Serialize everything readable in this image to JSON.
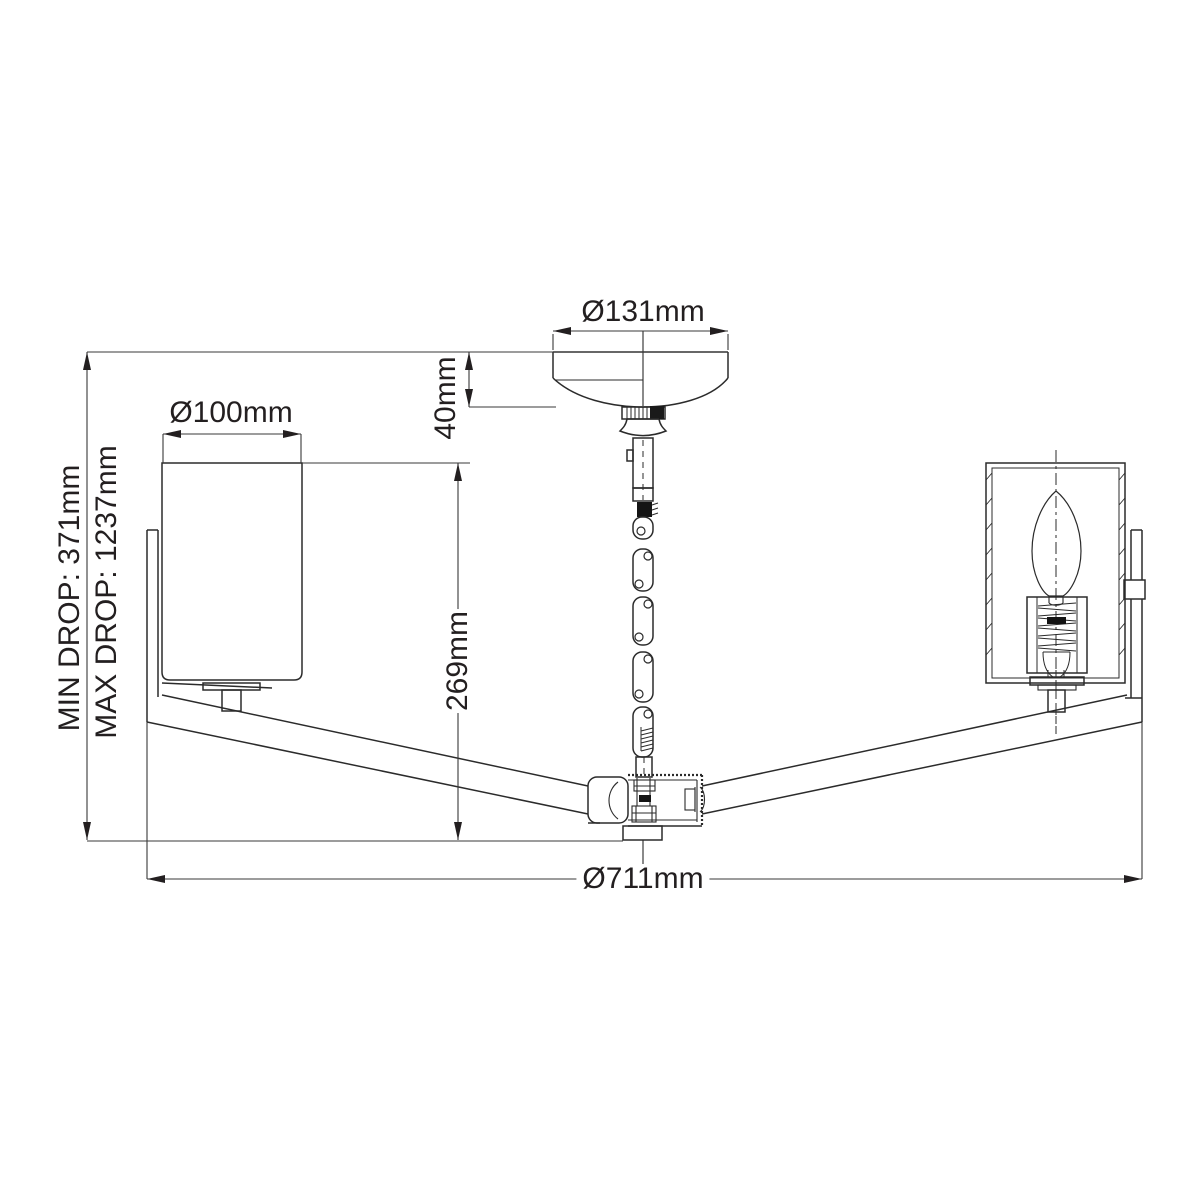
{
  "diagram": {
    "type": "technical line drawing, 2-arm ceiling light / chandelier side elevation with dimensions",
    "background_color": "#ffffff",
    "line_color": "#2b2b2b",
    "dimension_line_color": "#3a3a3a",
    "text_color": "#231f20",
    "labels": {
      "canopy_diameter": "Ø131mm",
      "canopy_height": "40mm",
      "shade_diameter": "Ø100mm",
      "body_drop": "269mm",
      "min_drop": "MIN DROP: 371mm",
      "max_drop": "MAX DROP: 1237mm",
      "overall_diameter": "Ø711mm"
    }
  }
}
